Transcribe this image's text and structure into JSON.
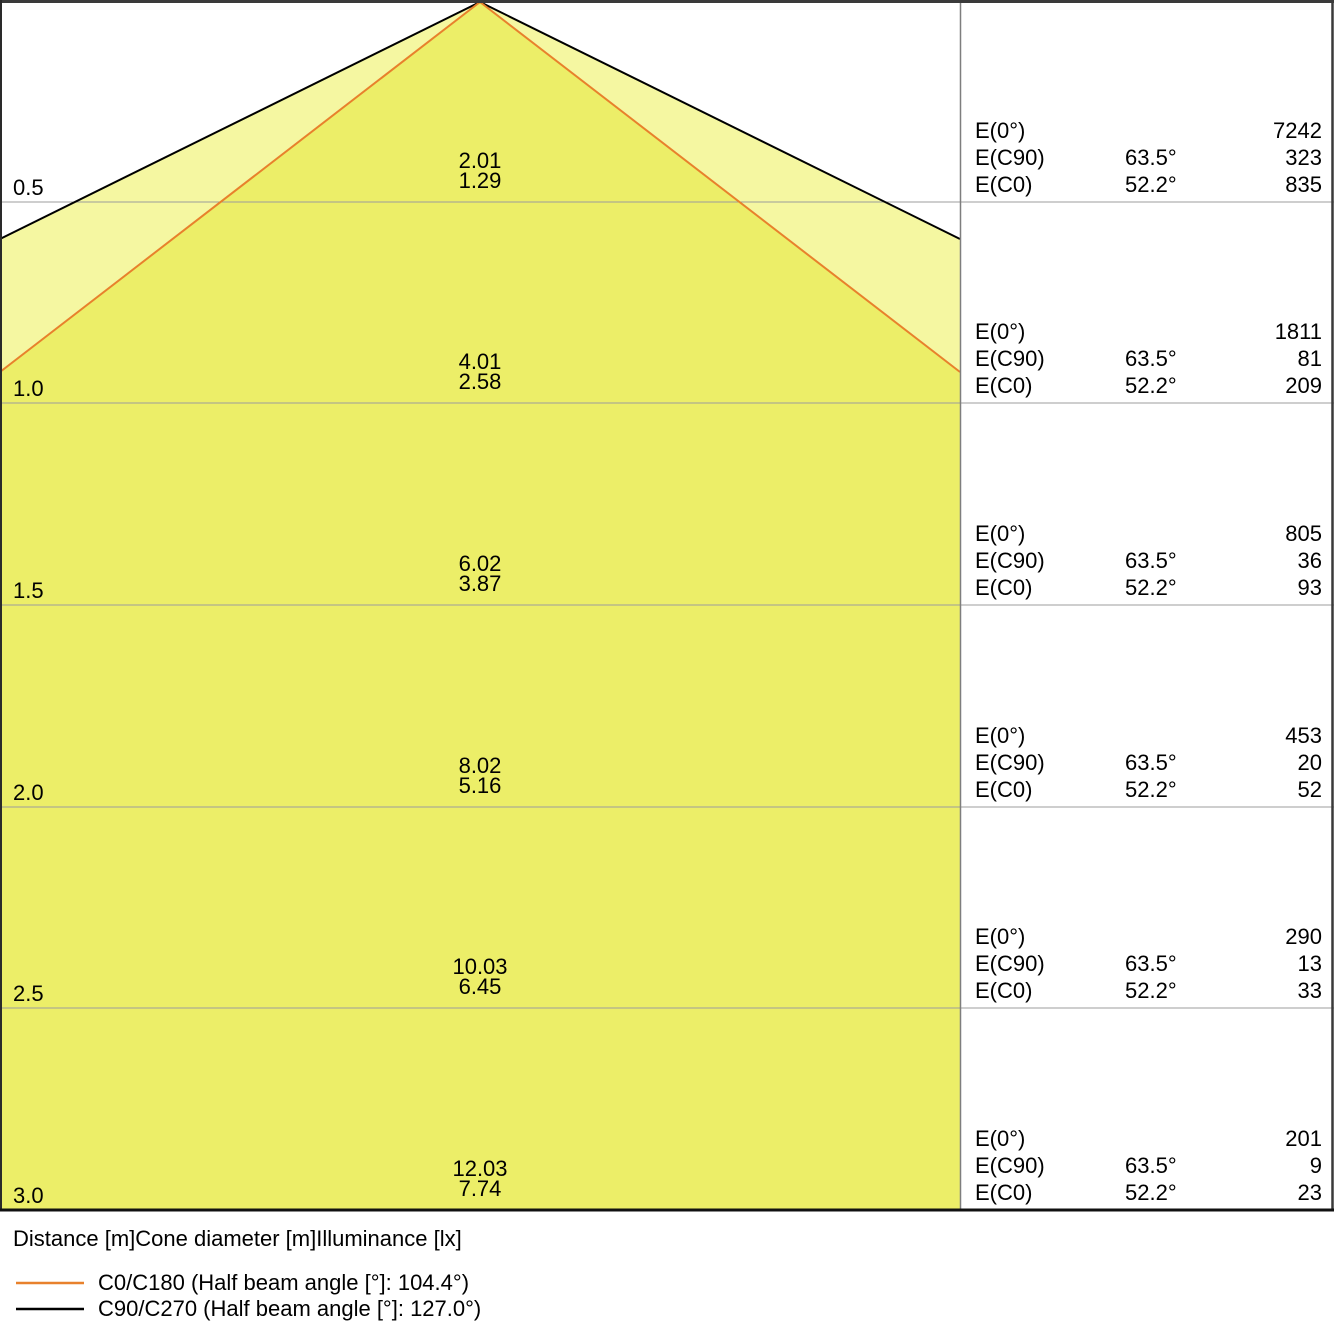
{
  "colors": {
    "background": "#FFFFFF",
    "text": "#000000",
    "beam_inner_fill": "#ECEE68",
    "beam_outer_fill": "#F5F7A1",
    "c0_beam_line": "#E8812C",
    "c90_beam_line": "#000000"
  },
  "chart_data": {
    "type": "table",
    "columns": [
      "Distance [m]",
      "Cone diameter [m]",
      "Illuminance [lx]"
    ],
    "caption": "Distance [m]Cone diameter [m]Illuminance [lx]",
    "labels": {
      "e0": "E(0°)",
      "ec90": "E(C90)",
      "ec0": "E(C0)"
    },
    "rows": [
      {
        "distance": "0.5",
        "cone_c90": "2.01",
        "cone_c0": "1.29",
        "e0": "7242",
        "ec90_angle": "63.5°",
        "ec90": "323",
        "ec0_angle": "52.2°",
        "ec0": "835"
      },
      {
        "distance": "1.0",
        "cone_c90": "4.01",
        "cone_c0": "2.58",
        "e0": "1811",
        "ec90_angle": "63.5°",
        "ec90": "81",
        "ec0_angle": "52.2°",
        "ec0": "209"
      },
      {
        "distance": "1.5",
        "cone_c90": "6.02",
        "cone_c0": "3.87",
        "e0": "805",
        "ec90_angle": "63.5°",
        "ec90": "36",
        "ec0_angle": "52.2°",
        "ec0": "93"
      },
      {
        "distance": "2.0",
        "cone_c90": "8.02",
        "cone_c0": "5.16",
        "e0": "453",
        "ec90_angle": "63.5°",
        "ec90": "20",
        "ec0_angle": "52.2°",
        "ec0": "52"
      },
      {
        "distance": "2.5",
        "cone_c90": "10.03",
        "cone_c0": "6.45",
        "e0": "290",
        "ec90_angle": "63.5°",
        "ec90": "13",
        "ec0_angle": "52.2°",
        "ec0": "33"
      },
      {
        "distance": "3.0",
        "cone_c90": "12.03",
        "cone_c0": "7.74",
        "e0": "201",
        "ec90_angle": "63.5°",
        "ec90": "9",
        "ec0_angle": "52.2°",
        "ec0": "23"
      }
    ],
    "legend": [
      {
        "series": "C0/C180",
        "label": "C0/C180 (Half beam angle [°]: 104.4°)",
        "half_beam_angle_deg": 104.4,
        "half_angle_deg": 52.2
      },
      {
        "series": "C90/C270",
        "label": "C90/C270 (Half beam angle [°]: 127.0°)",
        "half_beam_angle_deg": 127.0,
        "half_angle_deg": 63.5
      }
    ]
  }
}
